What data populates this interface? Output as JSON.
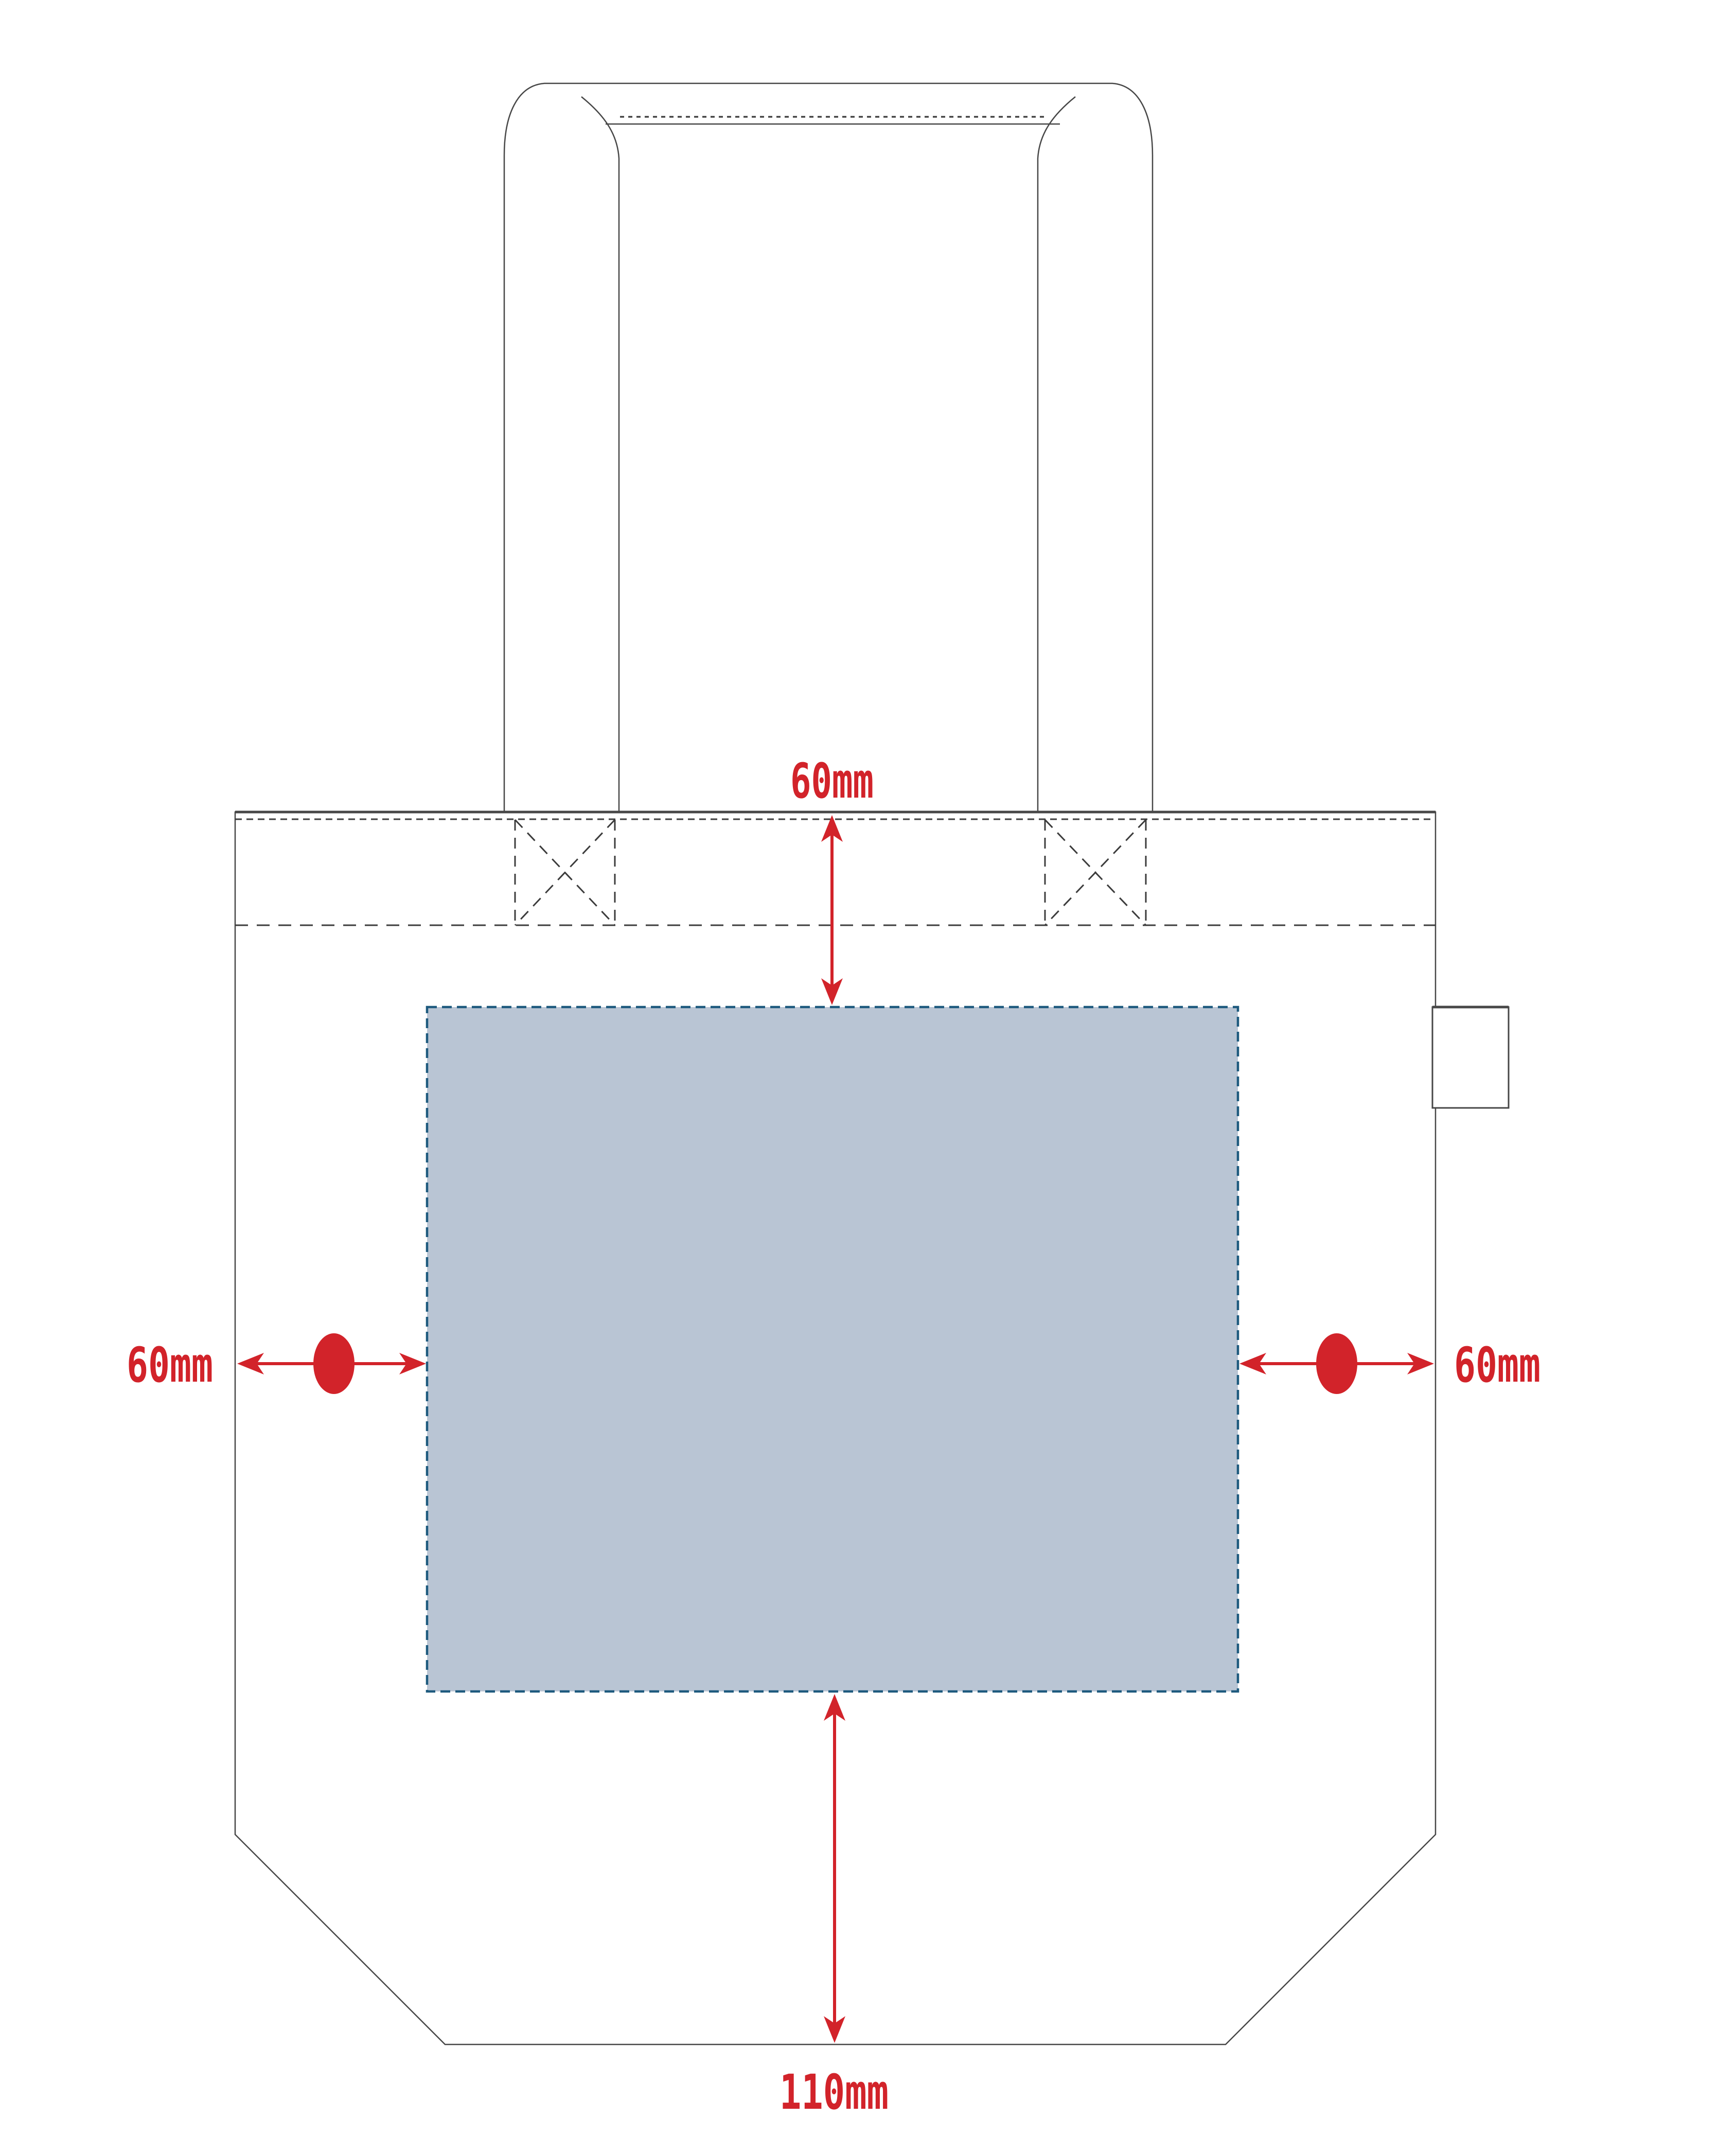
{
  "diagram": {
    "name": "tote-bag-print-area-template",
    "product_view": "tote bag front with shoulder handle, hem stitching, side loop tag and printable area"
  },
  "dimensions": {
    "top": {
      "label": "60mm",
      "meaning": "distance from top seam to print area"
    },
    "left": {
      "label": "60mm",
      "meaning": "distance from left edge to print area"
    },
    "right": {
      "label": "60mm",
      "meaning": "distance from right edge to print area"
    },
    "bottom": {
      "label": "110mm",
      "meaning": "distance from print area to bag bottom"
    }
  },
  "colors": {
    "dimension_red": "#d2232a",
    "print_area_fill": "#b9c5d4",
    "print_area_border": "#1e5a7e",
    "outline_gray": "#474747",
    "stitch_gray": "#3c3c3c"
  }
}
